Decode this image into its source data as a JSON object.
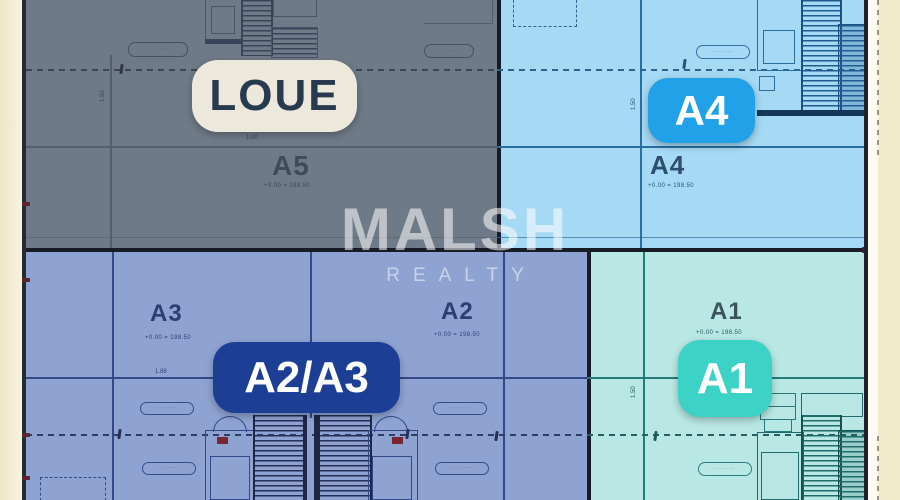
{
  "watermark": {
    "brand": "MALSH",
    "sub": "REALTY"
  },
  "units": {
    "a5": {
      "badge": "LOUE",
      "label": "A5",
      "elevation": "+0.00 = 198.50"
    },
    "a4": {
      "badge": "A4",
      "label": "A4",
      "elevation": "+0.00 = 198.50"
    },
    "a2a3": {
      "badge": "A2/A3"
    },
    "a3": {
      "label": "A3",
      "elevation": "+0.00 = 198.50"
    },
    "a2": {
      "label": "A2",
      "elevation": "+0.00 = 198.50"
    },
    "a1": {
      "badge": "A1",
      "label": "A1",
      "elevation": "+0.00 = 198.50"
    }
  },
  "dims": {
    "d100": "1.00",
    "d150": "1.50",
    "d188": "1.88",
    "d1760": "1.760"
  },
  "pills": {
    "text": "·······"
  },
  "colors": {
    "beige": "#f0ebcd",
    "boundary": "#181c26",
    "a5bg": "#6f7a88",
    "a4bg": "#a6d9f3",
    "a2a3bg": "#8fa3d3",
    "a1bg": "#b9e8e4",
    "loueBg": "#ece8db",
    "loueText": "#273a4e",
    "a4Badge": "#21a1e8",
    "a2a3Badge": "#1c3e95",
    "a1Badge": "#3dd2c6",
    "wm1": "rgba(255,255,255,0.55)",
    "wm2": "rgba(255,255,255,0.5)"
  }
}
